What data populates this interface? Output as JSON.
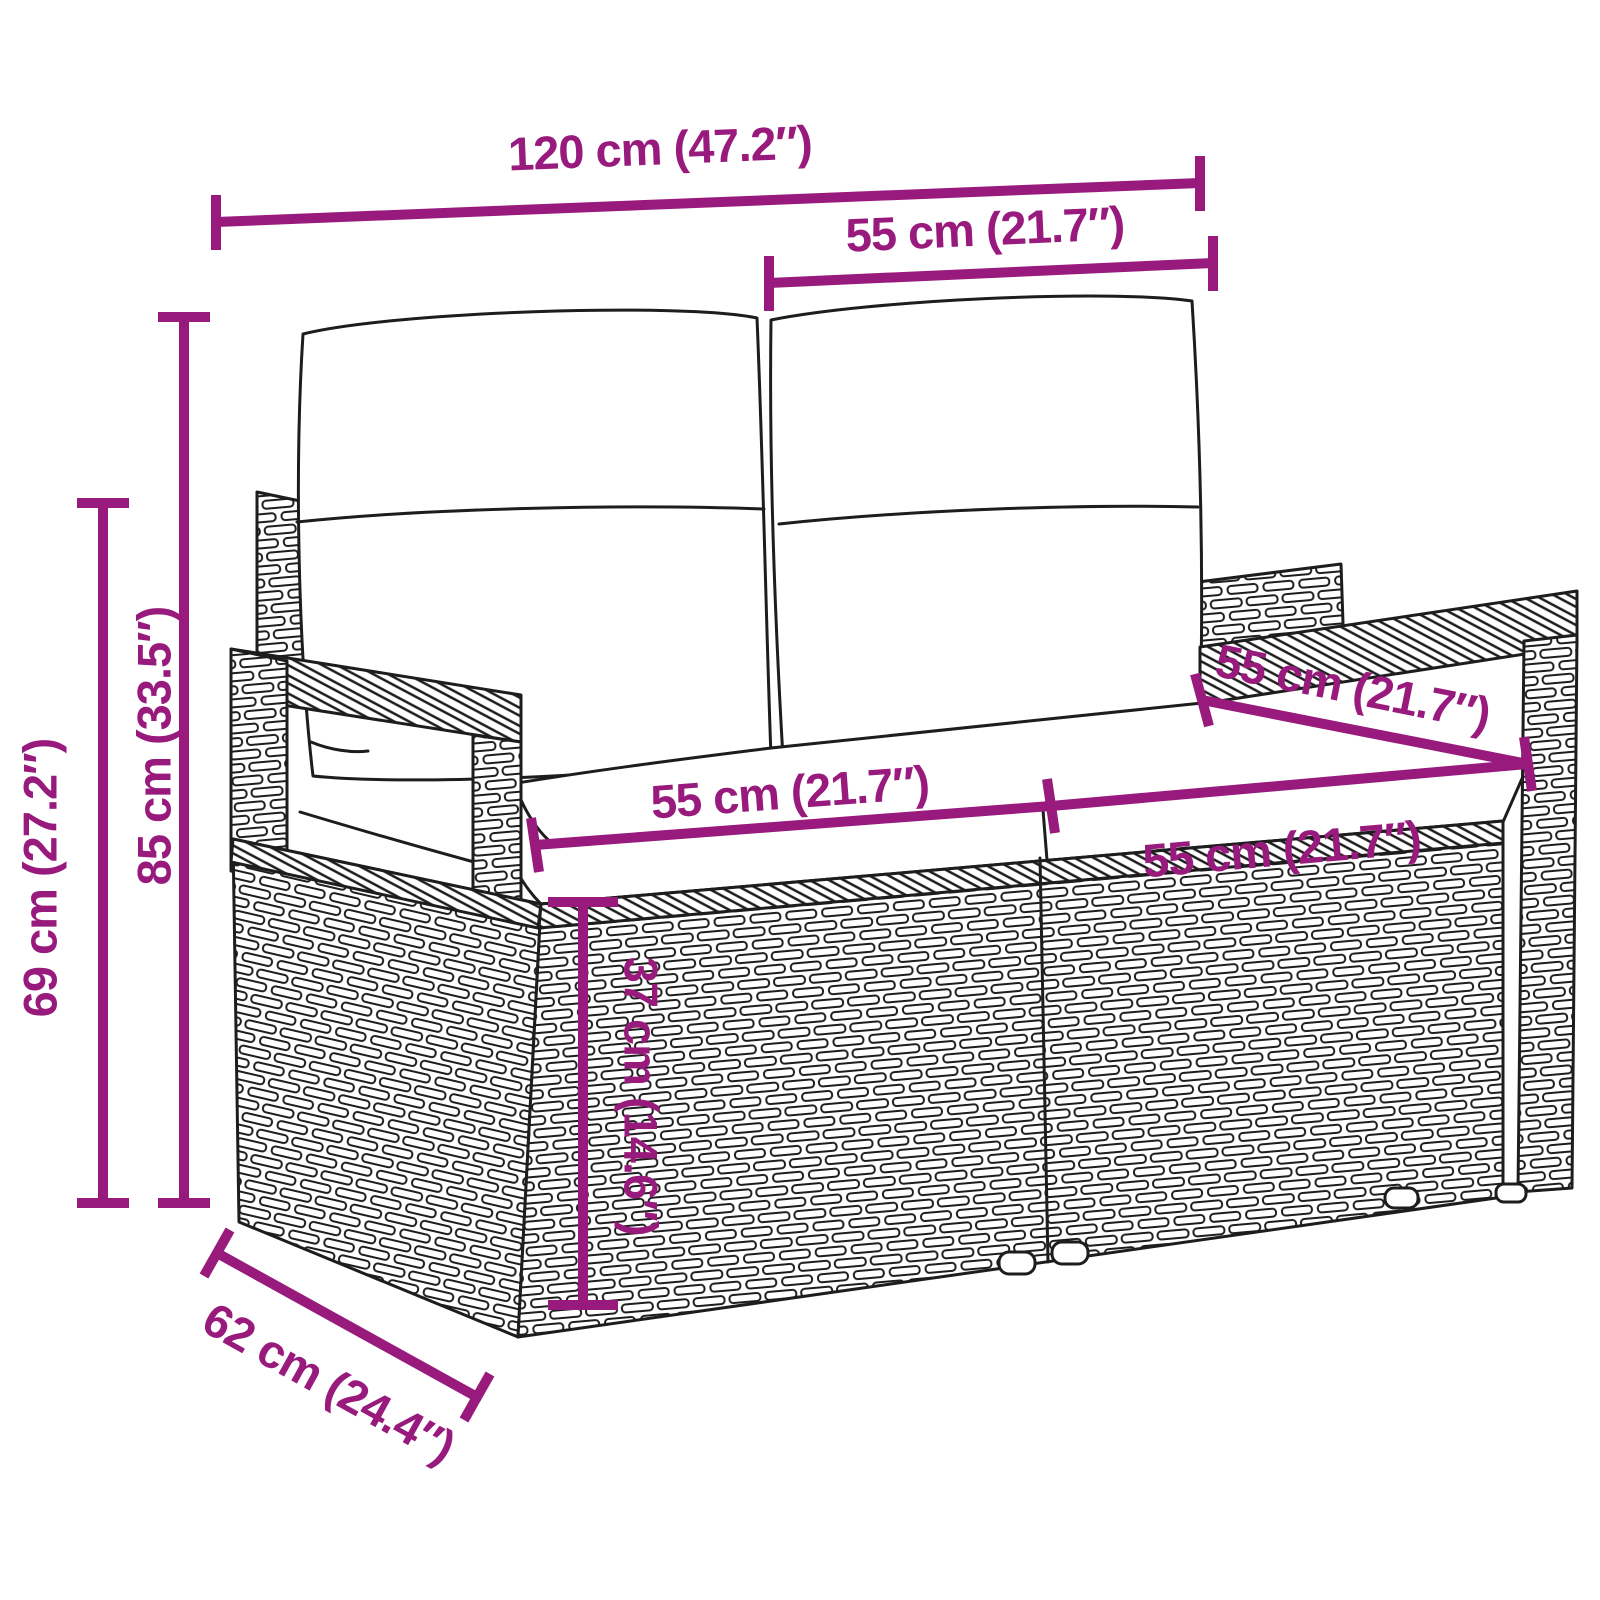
{
  "page": {
    "background_color": "#FFFFFF"
  },
  "figure": {
    "description": "Line drawing of a two-seater poly rattan garden bench with back cushions and seat cushions",
    "stroke_color": "#1D1D1D",
    "fill_color": "#FFFFFF"
  },
  "dimensions": {
    "color": "#991A7D",
    "items": [
      {
        "id": "overall-width",
        "label": "120 cm (47.2″)"
      },
      {
        "id": "back-section-width",
        "label": "55 cm (21.7″)"
      },
      {
        "id": "total-height",
        "label": "85 cm (33.5″)"
      },
      {
        "id": "arm-height",
        "label": "69 cm (27.2″)"
      },
      {
        "id": "seat-width-left",
        "label": "55 cm (21.7″)"
      },
      {
        "id": "seat-width-right",
        "label": "55 cm (21.7″)"
      },
      {
        "id": "seat-depth",
        "label": "55 cm (21.7″)"
      },
      {
        "id": "seat-height",
        "label": "37 cm (14.6″)"
      },
      {
        "id": "overall-depth",
        "label": "62 cm (24.4″)"
      }
    ]
  }
}
